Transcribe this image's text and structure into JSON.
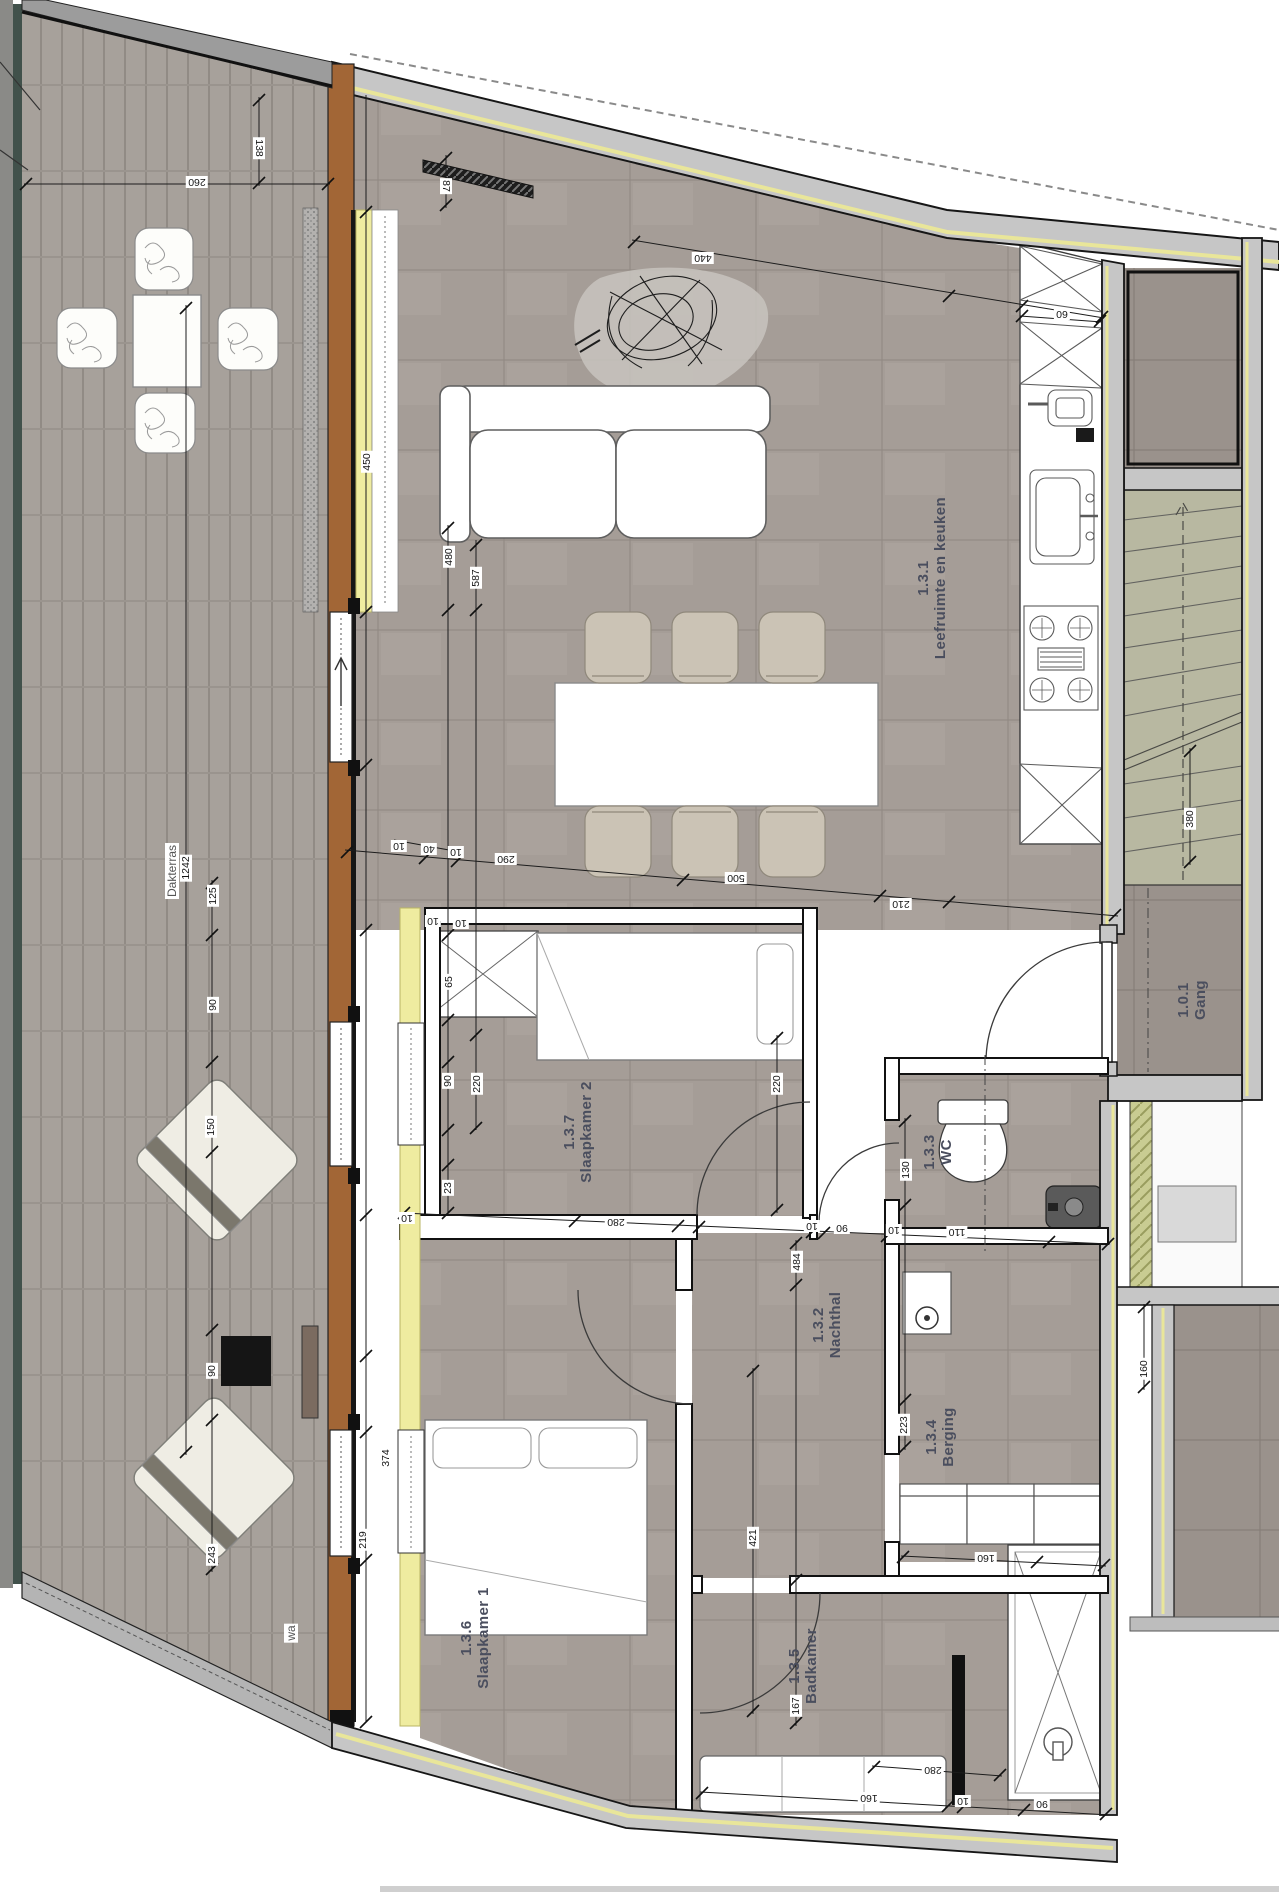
{
  "plan": {
    "rooms": [
      {
        "number": "1.3.1",
        "name": "Leefruimte en keuken",
        "cx": 932,
        "cy": 578
      },
      {
        "number": "1.3.7",
        "name": "Slaapkamer 2",
        "cx": 578,
        "cy": 1132
      },
      {
        "number": "1.3.6",
        "name": "Slaapkamer 1",
        "cx": 475,
        "cy": 1638
      },
      {
        "number": "1.3.2",
        "name": "Nachthal",
        "cx": 827,
        "cy": 1325
      },
      {
        "number": "1.3.3",
        "name": "WC",
        "cx": 938,
        "cy": 1152
      },
      {
        "number": "1.3.4",
        "name": "Berging",
        "cx": 940,
        "cy": 1437
      },
      {
        "number": "1.3.5",
        "name": "Badkamer",
        "cx": 803,
        "cy": 1666
      },
      {
        "number": "1.0.1",
        "name": "Gang",
        "cx": 1192,
        "cy": 1000
      }
    ],
    "area_labels": [
      {
        "text": "Dakterras",
        "cx": 172,
        "cy": 871
      },
      {
        "text": "wa",
        "cx": 291,
        "cy": 1633
      }
    ],
    "dimensions": [
      {
        "t": "260",
        "x": 197,
        "y": 182,
        "o": "h"
      },
      {
        "t": "138",
        "x": 259,
        "y": 148,
        "o": "v2"
      },
      {
        "t": "87",
        "x": 446,
        "y": 186,
        "o": "v2"
      },
      {
        "t": "440",
        "x": 703,
        "y": 258,
        "o": "h"
      },
      {
        "t": "60",
        "x": 1062,
        "y": 314,
        "o": "h"
      },
      {
        "t": "450",
        "x": 367,
        "y": 462,
        "o": "v"
      },
      {
        "t": "480",
        "x": 449,
        "y": 557,
        "o": "v"
      },
      {
        "t": "587",
        "x": 476,
        "y": 578,
        "o": "v"
      },
      {
        "t": "1242",
        "x": 186,
        "y": 868,
        "o": "v"
      },
      {
        "t": "125",
        "x": 213,
        "y": 896,
        "o": "v"
      },
      {
        "t": "90",
        "x": 213,
        "y": 1005,
        "o": "v"
      },
      {
        "t": "150",
        "x": 211,
        "y": 1127,
        "o": "v"
      },
      {
        "t": "90",
        "x": 212,
        "y": 1371,
        "o": "v"
      },
      {
        "t": "243",
        "x": 212,
        "y": 1555,
        "o": "v"
      },
      {
        "t": "10",
        "x": 399,
        "y": 846,
        "o": "h"
      },
      {
        "t": "40",
        "x": 429,
        "y": 849,
        "o": "h"
      },
      {
        "t": "10",
        "x": 456,
        "y": 852,
        "o": "h"
      },
      {
        "t": "290",
        "x": 506,
        "y": 859,
        "o": "h"
      },
      {
        "t": "500",
        "x": 736,
        "y": 878,
        "o": "h"
      },
      {
        "t": "210",
        "x": 901,
        "y": 904,
        "o": "h"
      },
      {
        "t": "10",
        "x": 433,
        "y": 921,
        "o": "h"
      },
      {
        "t": "10",
        "x": 461,
        "y": 923,
        "o": "h"
      },
      {
        "t": "65",
        "x": 449,
        "y": 982,
        "o": "v"
      },
      {
        "t": "90",
        "x": 448,
        "y": 1081,
        "o": "v"
      },
      {
        "t": "220",
        "x": 477,
        "y": 1084,
        "o": "v"
      },
      {
        "t": "220",
        "x": 777,
        "y": 1084,
        "o": "v"
      },
      {
        "t": "23",
        "x": 448,
        "y": 1188,
        "o": "v"
      },
      {
        "t": "10",
        "x": 407,
        "y": 1218,
        "o": "h"
      },
      {
        "t": "280",
        "x": 616,
        "y": 1222,
        "o": "h"
      },
      {
        "t": "10",
        "x": 812,
        "y": 1226,
        "o": "h"
      },
      {
        "t": "90",
        "x": 842,
        "y": 1228,
        "o": "h"
      },
      {
        "t": "10",
        "x": 894,
        "y": 1230,
        "o": "h"
      },
      {
        "t": "110",
        "x": 957,
        "y": 1232,
        "o": "h"
      },
      {
        "t": "130",
        "x": 906,
        "y": 1170,
        "o": "v"
      },
      {
        "t": "484",
        "x": 797,
        "y": 1262,
        "o": "v"
      },
      {
        "t": "421",
        "x": 753,
        "y": 1538,
        "o": "v"
      },
      {
        "t": "167",
        "x": 796,
        "y": 1706,
        "o": "v"
      },
      {
        "t": "374",
        "x": 386,
        "y": 1458,
        "o": "v"
      },
      {
        "t": "219",
        "x": 363,
        "y": 1540,
        "o": "v"
      },
      {
        "t": "223",
        "x": 904,
        "y": 1425,
        "o": "v"
      },
      {
        "t": "160",
        "x": 986,
        "y": 1558,
        "o": "h"
      },
      {
        "t": "160",
        "x": 1144,
        "y": 1369,
        "o": "v"
      },
      {
        "t": "380",
        "x": 1190,
        "y": 819,
        "o": "v"
      },
      {
        "t": "280",
        "x": 933,
        "y": 1770,
        "o": "h"
      },
      {
        "t": "160",
        "x": 869,
        "y": 1798,
        "o": "h"
      },
      {
        "t": "10",
        "x": 963,
        "y": 1801,
        "o": "h"
      },
      {
        "t": "90",
        "x": 1042,
        "y": 1804,
        "o": "h"
      }
    ],
    "dimension_lines": [
      [
        366,
        95,
        366,
        1722
      ],
      [
        448,
        525,
        448,
        1213
      ],
      [
        476,
        540,
        476,
        1130
      ],
      [
        777,
        1035,
        777,
        1213
      ],
      [
        796,
        1240,
        796,
        1726
      ],
      [
        753,
        1368,
        753,
        1714
      ],
      [
        905,
        1118,
        905,
        1450
      ],
      [
        212,
        880,
        212,
        1572
      ],
      [
        186,
        305,
        186,
        1455
      ],
      [
        259,
        97,
        259,
        186
      ],
      [
        446,
        155,
        446,
        208
      ],
      [
        1190,
        748,
        1190,
        865
      ],
      [
        1144,
        1304,
        1144,
        1390
      ],
      [
        345,
        850,
        1118,
        916
      ],
      [
        394,
        840,
        460,
        852
      ],
      [
        402,
        1213,
        1110,
        1244
      ],
      [
        24,
        184,
        330,
        184
      ],
      [
        632,
        240,
        1104,
        318
      ],
      [
        700,
        1792,
        1110,
        1815
      ],
      [
        872,
        1766,
        1002,
        1776
      ],
      [
        901,
        1556,
        1106,
        1566
      ],
      [
        1020,
        316,
        1102,
        322
      ]
    ],
    "ticks": [
      [
        366,
        212
      ],
      [
        366,
        612
      ],
      [
        366,
        765
      ],
      [
        366,
        930
      ],
      [
        366,
        1215
      ],
      [
        366,
        1356
      ],
      [
        366,
        1432
      ],
      [
        366,
        1560
      ],
      [
        366,
        1722
      ],
      [
        448,
        528
      ],
      [
        448,
        610
      ],
      [
        448,
        935
      ],
      [
        448,
        1020
      ],
      [
        448,
        1062
      ],
      [
        448,
        1130
      ],
      [
        448,
        1165
      ],
      [
        448,
        1213
      ],
      [
        476,
        545
      ],
      [
        476,
        610
      ],
      [
        476,
        1035
      ],
      [
        476,
        1128
      ],
      [
        777,
        1038
      ],
      [
        777,
        1210
      ],
      [
        796,
        1243
      ],
      [
        796,
        1285
      ],
      [
        796,
        1580
      ],
      [
        796,
        1723
      ],
      [
        753,
        1371
      ],
      [
        753,
        1711
      ],
      [
        905,
        1121
      ],
      [
        905,
        1205
      ],
      [
        905,
        1400
      ],
      [
        905,
        1447
      ],
      [
        212,
        883
      ],
      [
        212,
        935
      ],
      [
        212,
        1062
      ],
      [
        212,
        1152
      ],
      [
        212,
        1330
      ],
      [
        212,
        1420
      ],
      [
        212,
        1569
      ],
      [
        186,
        308
      ],
      [
        186,
        1452
      ],
      [
        259,
        100
      ],
      [
        259,
        183
      ],
      [
        446,
        158
      ],
      [
        446,
        205
      ],
      [
        1190,
        751
      ],
      [
        1190,
        862
      ],
      [
        1144,
        1307
      ],
      [
        1144,
        1387
      ],
      [
        347,
        852
      ],
      [
        425,
        858
      ],
      [
        457,
        861
      ],
      [
        683,
        880
      ],
      [
        880,
        896
      ],
      [
        949,
        902
      ],
      [
        1115,
        915
      ],
      [
        404,
        1213
      ],
      [
        575,
        1221
      ],
      [
        678,
        1226
      ],
      [
        699,
        1227
      ],
      [
        812,
        1232
      ],
      [
        824,
        1233
      ],
      [
        887,
        1236
      ],
      [
        1049,
        1242
      ],
      [
        1108,
        1244
      ],
      [
        26,
        184
      ],
      [
        328,
        184
      ],
      [
        634,
        242
      ],
      [
        949,
        296
      ],
      [
        1022,
        306
      ],
      [
        1102,
        317
      ],
      [
        702,
        1793
      ],
      [
        948,
        1806
      ],
      [
        963,
        1807
      ],
      [
        1024,
        1810
      ],
      [
        1106,
        1814
      ],
      [
        874,
        1767
      ],
      [
        1000,
        1775
      ],
      [
        903,
        1557
      ],
      [
        1037,
        1562
      ],
      [
        1104,
        1565
      ],
      [
        1022,
        316
      ],
      [
        1100,
        321
      ]
    ],
    "colors": {
      "floor_terrace": "#a7a19b",
      "floor_interior": "#a59d97",
      "floor_dark": "#9a928c",
      "wall_gray": "#c6c6c6",
      "insulation_yellow": "#efeca0",
      "wood_orange": "#a26636",
      "stairs_green": "#b8b8a1",
      "hatch_green": "#c9cc92",
      "label_color": "#4a4e5e"
    }
  }
}
